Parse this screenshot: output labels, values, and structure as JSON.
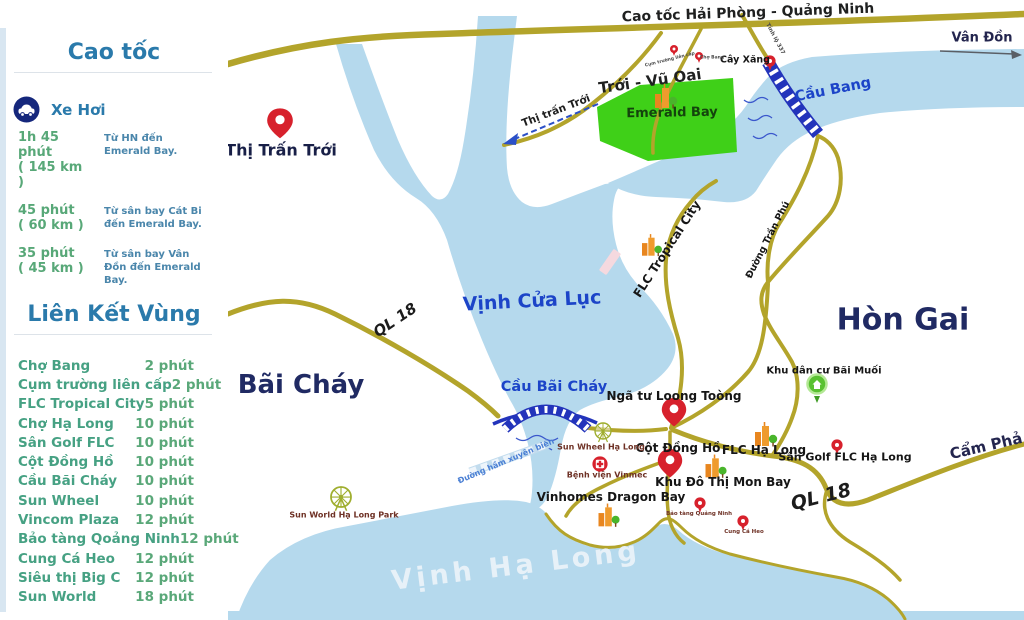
{
  "sidebar": {
    "highway_section": {
      "title": "Cao tốc"
    },
    "car_section": {
      "label": "Xe Hơi",
      "icon": "car-icon"
    },
    "trips": [
      {
        "time": "1h 45 phút",
        "distance": "( 145 km )",
        "desc": "Từ HN đến Emerald Bay."
      },
      {
        "time": "45 phút",
        "distance": "( 60 km )",
        "desc": "Từ sân bay Cát Bi đến Emerald Bay."
      },
      {
        "time": "35 phút",
        "distance": "( 45 km )",
        "desc": "Từ sân bay Vân Đồn đến Emerald Bay."
      }
    ],
    "links_section": {
      "title": "Liên Kết  Vùng"
    },
    "links": [
      {
        "name": "Chợ Bang",
        "time": "2 phút"
      },
      {
        "name": "Cụm trường liên cấp",
        "time": "2 phút"
      },
      {
        "name": "FLC Tropical City",
        "time": "5 phút"
      },
      {
        "name": "Chợ Hạ Long",
        "time": "10 phút"
      },
      {
        "name": "Sân Golf FLC",
        "time": "10 phút"
      },
      {
        "name": "Cột Đồng Hồ",
        "time": "10 phút"
      },
      {
        "name": "Cầu Bãi Cháy",
        "time": "10 phút"
      },
      {
        "name": "Sun Wheel",
        "time": "10 phút"
      },
      {
        "name": "Vincom Plaza",
        "time": "12 phút"
      },
      {
        "name": "Bảo tàng Qoảng Ninh",
        "time": "12 phút"
      },
      {
        "name": "Cung Cá Heo",
        "time": "12 phút"
      },
      {
        "name": "Siêu thị Big C",
        "time": "12 phút"
      },
      {
        "name": "Sun World",
        "time": "18 phút"
      }
    ]
  },
  "map": {
    "colors": {
      "water": "#b5d9ed",
      "road": "#b3a42b",
      "bridge_blue": "#2334bb",
      "marker_red": "#d7212c",
      "emerald_green": "#3fd018",
      "poi_green": "#49b52b",
      "label_navy": "#202a63",
      "water_label_blue": "#1c44c8"
    },
    "labels": [
      {
        "id": "cao-toc-hai-phong-quang-ninh",
        "text": "Cao tốc Hải Phòng - Quảng Ninh",
        "x": 748,
        "y": 13,
        "r": -2,
        "cls": "road-big"
      },
      {
        "id": "van-don",
        "text": "Vân Đồn",
        "x": 982,
        "y": 38,
        "r": 0,
        "cls": "city-sm"
      },
      {
        "id": "troi-vu-oai",
        "text": "Trới - Vũ Oai",
        "x": 650,
        "y": 81,
        "r": -8,
        "cls": "area"
      },
      {
        "id": "emerald-bay",
        "text": "Emerald Bay",
        "x": 672,
        "y": 113,
        "r": -1,
        "cls": "emerald"
      },
      {
        "id": "cay-xang",
        "text": "Cây Xăng",
        "x": 745,
        "y": 60,
        "r": 0,
        "cls": "poi-xs"
      },
      {
        "id": "cum-truong-lien-cap",
        "text": "Cụm trường liên cấp",
        "x": 670,
        "y": 60,
        "r": -14,
        "cls": "micro"
      },
      {
        "id": "cho-bang",
        "text": "Chợ Bang",
        "x": 712,
        "y": 58,
        "r": 0,
        "cls": "micro"
      },
      {
        "id": "tinh-lo-337",
        "text": "Tỉnh lộ 337",
        "x": 775,
        "y": 39,
        "r": 62,
        "cls": "micro2"
      },
      {
        "id": "cau-bang",
        "text": "Cầu Bang",
        "x": 833,
        "y": 90,
        "r": -11,
        "cls": "bridge"
      },
      {
        "id": "thi-tran-troi-direction",
        "text": "Thị trấn Trới",
        "x": 556,
        "y": 111,
        "r": -21,
        "cls": "dir"
      },
      {
        "id": "thi-tran-troi",
        "text": "Thị Trấn Trới",
        "x": 281,
        "y": 150,
        "r": 0,
        "cls": "city-md"
      },
      {
        "id": "flc-tropical-city",
        "text": "FLC Tropical City",
        "x": 667,
        "y": 249,
        "r": -57,
        "cls": "poi-md"
      },
      {
        "id": "duong-tran-phu",
        "text": "Đường Trần Phú",
        "x": 768,
        "y": 240,
        "r": -63,
        "cls": "poi-sm"
      },
      {
        "id": "vinh-cua-luc",
        "text": "Vịnh Cửa Lục",
        "x": 532,
        "y": 301,
        "r": -3,
        "cls": "water-big"
      },
      {
        "id": "ql-18-west",
        "text": "QL 18",
        "x": 395,
        "y": 320,
        "r": -34,
        "cls": "ql"
      },
      {
        "id": "bai-chay",
        "text": "Bãi Cháy",
        "x": 301,
        "y": 385,
        "r": 0,
        "cls": "city-lg"
      },
      {
        "id": "hon-gai",
        "text": "Hòn Gai",
        "x": 903,
        "y": 320,
        "r": 0,
        "cls": "city-xl"
      },
      {
        "id": "cau-bai-chay",
        "text": "Cầu Bãi Cháy",
        "x": 554,
        "y": 387,
        "r": 0,
        "cls": "bridge"
      },
      {
        "id": "nga-tu-loong-toong",
        "text": "Ngã tư Loong Toòng",
        "x": 674,
        "y": 396,
        "r": 0,
        "cls": "poi-lg"
      },
      {
        "id": "cot-dong-ho",
        "text": "Cột Đồng Hồ",
        "x": 678,
        "y": 448,
        "r": 0,
        "cls": "poi-lg"
      },
      {
        "id": "flc-ha-long",
        "text": "FLC Hạ Long",
        "x": 764,
        "y": 450,
        "r": 0,
        "cls": "poi-lg"
      },
      {
        "id": "san-golf-flc-ha-long",
        "text": "Sân Golf  FLC Hạ Long",
        "x": 845,
        "y": 457,
        "r": 0,
        "cls": "poi-md2"
      },
      {
        "id": "khu-dan-cu-bai-muoi",
        "text": "Khu dân cư Bãi Muối",
        "x": 824,
        "y": 371,
        "r": 0,
        "cls": "poi-sm2"
      },
      {
        "id": "khu-do-thi-mon-bay",
        "text": "Khu Đô Thị Mon Bay",
        "x": 723,
        "y": 482,
        "r": 0,
        "cls": "poi-lg"
      },
      {
        "id": "vinhomes-dragon-bay",
        "text": "Vinhomes Dragon Bay",
        "x": 611,
        "y": 497,
        "r": 0,
        "cls": "poi-lg"
      },
      {
        "id": "sun-wheel-ha-long",
        "text": "Sun Wheel Hạ Long",
        "x": 601,
        "y": 447,
        "r": 0,
        "cls": "leisure"
      },
      {
        "id": "benh-vien-vinmec",
        "text": "Bệnh viện Vinmec",
        "x": 607,
        "y": 475,
        "r": 0,
        "cls": "leisure"
      },
      {
        "id": "bao-tang-quang-ninh",
        "text": "Bảo tàng Quảng Ninh",
        "x": 699,
        "y": 514,
        "r": 0,
        "cls": "leisure-xs"
      },
      {
        "id": "cung-ca-heo",
        "text": "Cung Cá Heo",
        "x": 744,
        "y": 532,
        "r": 0,
        "cls": "leisure-xs"
      },
      {
        "id": "sun-world-ha-long-park",
        "text": "Sun  World Hạ Long Park",
        "x": 344,
        "y": 515,
        "r": 0,
        "cls": "leisure"
      },
      {
        "id": "duong-ham-xuyen-bien",
        "text": "Đường hầm xuyên biển",
        "x": 506,
        "y": 461,
        "r": -23,
        "cls": "tunnel"
      },
      {
        "id": "cam-pha",
        "text": "Cẩm Phả",
        "x": 986,
        "y": 446,
        "r": -13,
        "cls": "city-md2"
      },
      {
        "id": "ql-18-southeast",
        "text": "QL 18",
        "x": 821,
        "y": 497,
        "r": -14,
        "cls": "ql-big"
      },
      {
        "id": "vinh-ha-long",
        "text": "Vịnh Hạ Long",
        "x": 516,
        "y": 566,
        "r": -7,
        "cls": "sea"
      }
    ]
  }
}
